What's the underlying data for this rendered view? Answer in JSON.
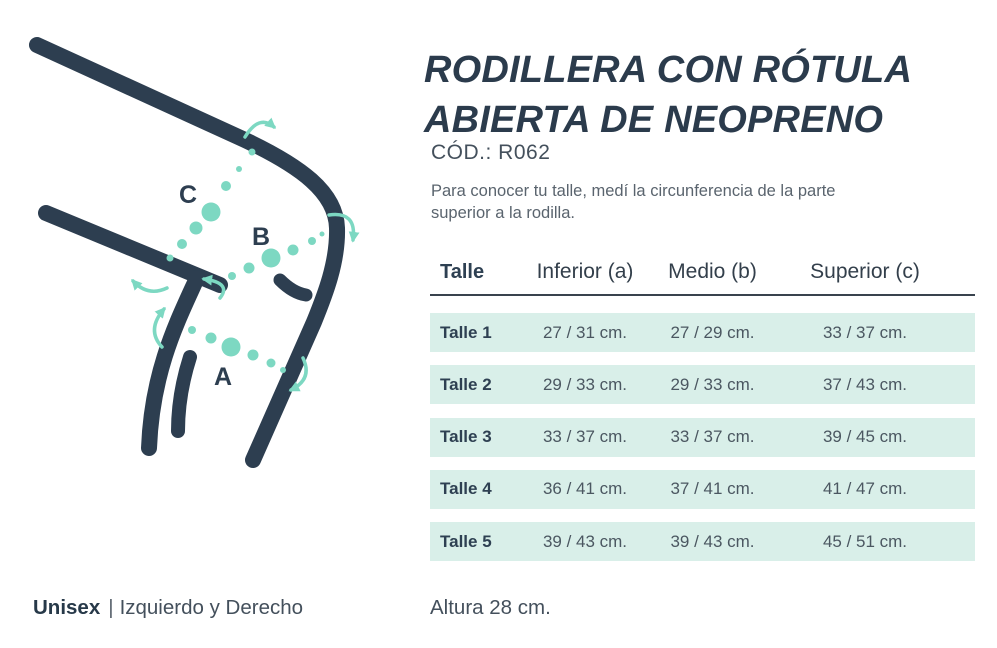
{
  "product": {
    "title_line1": "RODILLERA CON RÓTULA",
    "title_line2": "ABIERTA DE NEOPRENO",
    "code": "CÓD.: R062",
    "description_line1": "Para conocer tu talle, medí la circunferencia de la parte",
    "description_line2": "superior a la rodilla."
  },
  "illustration": {
    "labels": {
      "a": "A",
      "b": "B",
      "c": "C"
    },
    "colors": {
      "line": "#2d3e50",
      "accent": "#7dd8c2"
    }
  },
  "table": {
    "headers": [
      "Talle",
      "Inferior (a)",
      "Medio (b)",
      "Superior (c)"
    ],
    "row_background": "#d9efe9",
    "rows": [
      {
        "label": "Talle 1",
        "values": [
          "27 / 31 cm.",
          "27 / 29 cm.",
          "33 / 37 cm."
        ]
      },
      {
        "label": "Talle 2",
        "values": [
          "29 / 33 cm.",
          "29 / 33 cm.",
          "37 / 43 cm."
        ]
      },
      {
        "label": "Talle 3",
        "values": [
          "33 / 37 cm.",
          "33 / 37 cm.",
          "39 / 45 cm."
        ]
      },
      {
        "label": "Talle 4",
        "values": [
          "36 / 41 cm.",
          "37 / 41 cm.",
          "41 / 47 cm."
        ]
      },
      {
        "label": "Talle 5",
        "values": [
          "39 / 43 cm.",
          "39 / 43 cm.",
          "45 / 51 cm."
        ]
      }
    ]
  },
  "footer": {
    "gender": "Unisex",
    "separator": "|",
    "side": "Izquierdo y Derecho",
    "height": "Altura 28 cm."
  }
}
